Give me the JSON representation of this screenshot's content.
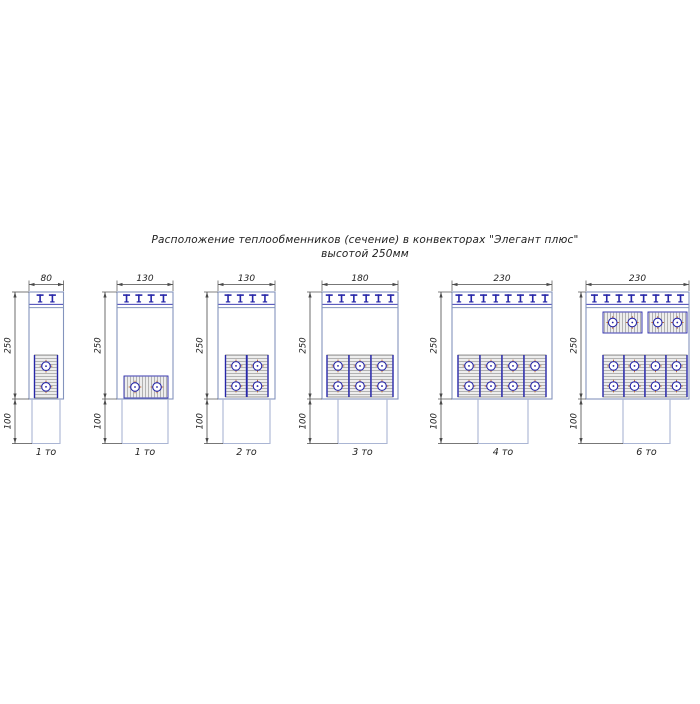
{
  "title": {
    "line1": "Расположение теплообменников (сечение) в конвекторах \"Элегант плюс\"",
    "line2": "высотой 250мм"
  },
  "colors": {
    "casing_outline": "#8494bd",
    "tail_outline": "#aab5d3",
    "navy": "#2626a8",
    "block_fill": "#ededed",
    "block_border": "#8f8f8f",
    "hatch": "#a3a3a3",
    "tube_tick_orange": "#bf6a3a",
    "dim_line": "#4a4a4a",
    "label_text": "#222222"
  },
  "layout_common": {
    "casing_y": 292,
    "casing_h": 107,
    "tail_h": 44.5,
    "grille_line1_y": 304.3,
    "grille_line2_y": 307.6,
    "top_dim_y": 284.5,
    "width_label_y": 281,
    "count_label_y": 455,
    "tooth_spacing": 12.3
  },
  "diagrams": [
    {
      "count_label": "1 то",
      "width_label": "80",
      "upper_height_label": "250",
      "lower_height_label": "100",
      "layout": {
        "casing_x": 29,
        "casing_w": 34.5,
        "tail_x": 32,
        "tail_w": 28,
        "dim_x": 15,
        "teeth": 2,
        "cells": [
          {
            "x": 34.5,
            "y": 355,
            "w": 23,
            "h": 43,
            "orient": "v"
          }
        ]
      }
    },
    {
      "count_label": "1 то",
      "width_label": "130",
      "upper_height_label": "250",
      "lower_height_label": "100",
      "layout": {
        "casing_x": 117,
        "casing_w": 56,
        "tail_x": 122,
        "tail_w": 46,
        "dim_x": 105,
        "teeth": 4,
        "cells": [
          {
            "x": 124,
            "y": 376,
            "w": 44,
            "h": 22,
            "orient": "h"
          }
        ]
      }
    },
    {
      "count_label": "2 то",
      "width_label": "130",
      "upper_height_label": "250",
      "lower_height_label": "100",
      "layout": {
        "casing_x": 218,
        "casing_w": 57,
        "tail_x": 223,
        "tail_w": 47,
        "dim_x": 207,
        "teeth": 4,
        "cells": [
          {
            "x": 225.5,
            "y": 355,
            "w": 21,
            "h": 42,
            "orient": "v"
          },
          {
            "x": 247,
            "y": 355,
            "w": 21,
            "h": 42,
            "orient": "v"
          }
        ]
      }
    },
    {
      "count_label": "3 то",
      "width_label": "180",
      "upper_height_label": "250",
      "lower_height_label": "100",
      "layout": {
        "casing_x": 322,
        "casing_w": 76,
        "tail_x": 338,
        "tail_w": 49,
        "dim_x": 310,
        "teeth": 6,
        "cells": [
          {
            "x": 327,
            "y": 355,
            "w": 22,
            "h": 42,
            "orient": "v"
          },
          {
            "x": 349,
            "y": 355,
            "w": 22,
            "h": 42,
            "orient": "v"
          },
          {
            "x": 371,
            "y": 355,
            "w": 22,
            "h": 42,
            "orient": "v"
          }
        ]
      }
    },
    {
      "count_label": "4 то",
      "width_label": "230",
      "upper_height_label": "250",
      "lower_height_label": "100",
      "layout": {
        "casing_x": 452,
        "casing_w": 100,
        "tail_x": 478,
        "tail_w": 50,
        "dim_x": 441,
        "teeth": 8,
        "cells": [
          {
            "x": 458,
            "y": 355,
            "w": 22,
            "h": 42,
            "orient": "v"
          },
          {
            "x": 480,
            "y": 355,
            "w": 22,
            "h": 42,
            "orient": "v"
          },
          {
            "x": 502,
            "y": 355,
            "w": 22,
            "h": 42,
            "orient": "v"
          },
          {
            "x": 524,
            "y": 355,
            "w": 22,
            "h": 42,
            "orient": "v"
          }
        ]
      }
    },
    {
      "count_label": "6 то",
      "width_label": "230",
      "upper_height_label": "250",
      "lower_height_label": "100",
      "layout": {
        "casing_x": 586,
        "casing_w": 103,
        "tail_x": 623,
        "tail_w": 47,
        "dim_x": 581,
        "teeth": 8,
        "cells": [
          {
            "x": 603,
            "y": 312,
            "w": 39,
            "h": 21,
            "orient": "h"
          },
          {
            "x": 648,
            "y": 312,
            "w": 39,
            "h": 21,
            "orient": "h"
          },
          {
            "x": 603,
            "y": 355,
            "w": 21,
            "h": 42,
            "orient": "v"
          },
          {
            "x": 624,
            "y": 355,
            "w": 21,
            "h": 42,
            "orient": "v"
          },
          {
            "x": 645,
            "y": 355,
            "w": 21,
            "h": 42,
            "orient": "v"
          },
          {
            "x": 666,
            "y": 355,
            "w": 21,
            "h": 42,
            "orient": "v"
          }
        ]
      }
    }
  ]
}
